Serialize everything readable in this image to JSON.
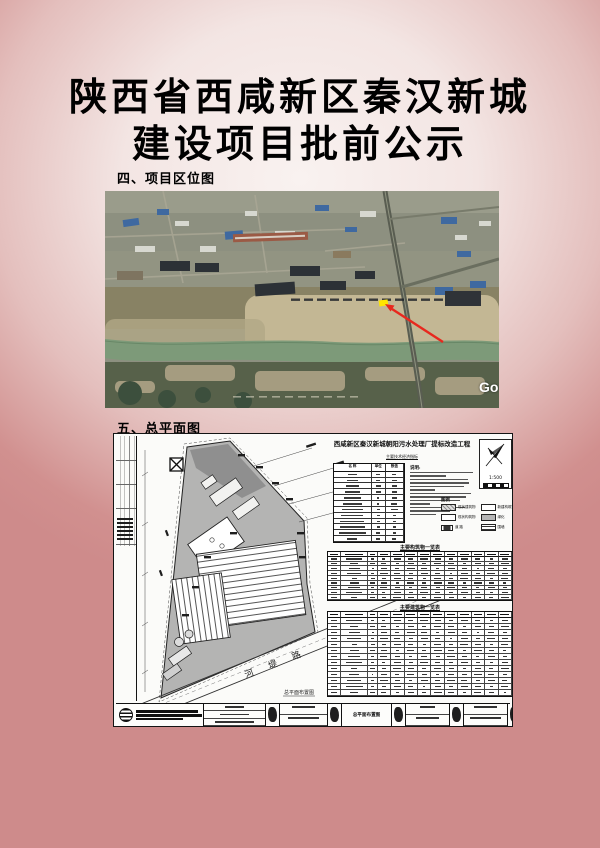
{
  "page": {
    "title_line1": "陕西省西咸新区秦汉新城",
    "title_line2": "建设项目批前公示",
    "section_location_label": "四、项目区位图",
    "section_siteplan_label": "五、总平面图"
  },
  "map": {
    "watermark": "Go",
    "marker_color": "#ffe600",
    "arrow_color": "#e8281e"
  },
  "plan": {
    "title": "西咸新区秦汉新城朝阳污水处理厂提标改造工程",
    "subtitle": "主要技术经济指标",
    "notes_label": "说明:",
    "north_scale": "1:500",
    "legend_title": "图例",
    "legend_items": [
      {
        "label": "现状建筑物",
        "style": "hatch"
      },
      {
        "label": "新建构筑物",
        "style": "white"
      },
      {
        "label": "现状构筑物",
        "style": "white"
      },
      {
        "label": "绿化",
        "style": "gray"
      },
      {
        "label": "道 路",
        "style": "dark"
      },
      {
        "label": "围墙",
        "style": "striped"
      }
    ],
    "indicator_table": {
      "headers": [
        "名  称",
        "单位",
        "数值"
      ],
      "row_count": 12
    },
    "table1": {
      "caption": "主要构筑物一览表",
      "rows": 10,
      "cols": 13
    },
    "table2": {
      "caption": "主要建筑物一览表",
      "rows": 14,
      "cols": 13
    },
    "road_label": "河 堤 路",
    "corner_label": "总平面布置图",
    "titleblock": {
      "sheet_name": "总平面布置图"
    }
  }
}
